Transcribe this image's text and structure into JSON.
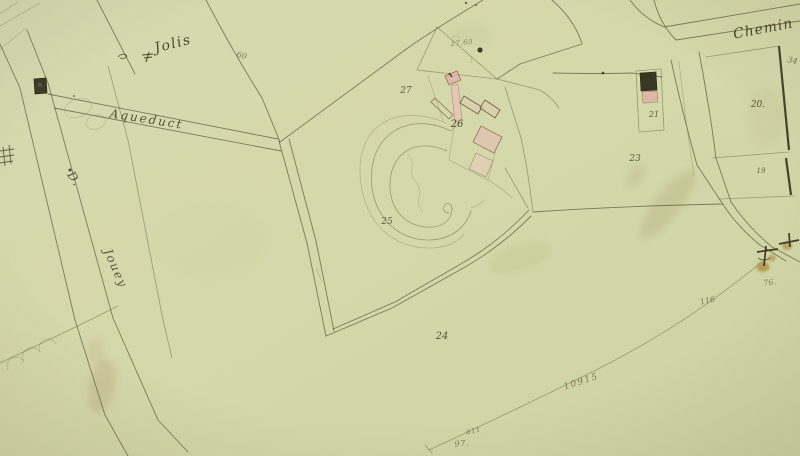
{
  "map": {
    "type": "cadastral-map-scan",
    "colors": {
      "paper": "#d6d9ac",
      "ink": "#5a553b",
      "ink_dark": "#2c2717",
      "building_pink": "#e0b4a8",
      "building_dark": "#2e2a1a",
      "stain_brown": "#a58a5c",
      "tree_ochre": "#a8893c",
      "measure_brown": "#7a5a36"
    },
    "labels": [
      {
        "name": "place-label-jolis",
        "text": "Jolis",
        "x": 174,
        "y": 48,
        "rot": -14,
        "size": 14,
        "ls": 1.5,
        "color": "#3d371f",
        "op": 0.9
      },
      {
        "name": "road-label-aqueduct",
        "text": "Aqueduct",
        "x": 146,
        "y": 123,
        "rot": 9,
        "size": 12,
        "ls": 2,
        "color": "#46402a",
        "op": 0.9
      },
      {
        "name": "road-label-d",
        "text": "D.",
        "x": 71,
        "y": 181,
        "rot": 55,
        "size": 12,
        "ls": 1,
        "color": "#46402a",
        "op": 0.85
      },
      {
        "name": "road-label-jouey",
        "text": "Jouey",
        "x": 112,
        "y": 270,
        "rot": 66,
        "size": 12,
        "ls": 1.5,
        "color": "#46402a",
        "op": 0.85
      },
      {
        "name": "road-label-chemin",
        "text": "Chemin",
        "x": 764,
        "y": 33,
        "rot": -11,
        "size": 14,
        "ls": 1,
        "color": "#3a3419",
        "op": 0.9
      },
      {
        "name": "parcel-number-27",
        "text": "27",
        "x": 406,
        "y": 93,
        "rot": 0,
        "size": 9,
        "ls": 0,
        "color": "#4a4429",
        "op": 0.85
      },
      {
        "name": "parcel-number-26",
        "text": "26",
        "x": 457,
        "y": 127,
        "rot": 0,
        "size": 10,
        "ls": 0,
        "color": "#433d24",
        "op": 0.9
      },
      {
        "name": "parcel-number-25",
        "text": "25",
        "x": 387,
        "y": 224,
        "rot": 0,
        "size": 9,
        "ls": 0,
        "color": "#4a4429",
        "op": 0.85
      },
      {
        "name": "parcel-number-24",
        "text": "24",
        "x": 442,
        "y": 339,
        "rot": 0,
        "size": 10,
        "ls": 0,
        "color": "#433d24",
        "op": 0.85
      },
      {
        "name": "parcel-number-23",
        "text": "23",
        "x": 635,
        "y": 161,
        "rot": 0,
        "size": 9,
        "ls": 0,
        "color": "#4a4429",
        "op": 0.85
      },
      {
        "name": "parcel-number-21",
        "text": "21",
        "x": 654,
        "y": 117,
        "rot": 0,
        "size": 8,
        "ls": 0,
        "color": "#4a4429",
        "op": 0.85
      },
      {
        "name": "parcel-number-20",
        "text": "20.",
        "x": 758,
        "y": 107,
        "rot": 0,
        "size": 9,
        "ls": 0,
        "color": "#433d24",
        "op": 0.85
      },
      {
        "name": "parcel-number-19",
        "text": "19",
        "x": 761,
        "y": 173,
        "rot": 0,
        "size": 7,
        "ls": 0,
        "color": "#4a4429",
        "op": 0.8
      },
      {
        "name": "parcel-number-34",
        "text": "34",
        "x": 792,
        "y": 63,
        "rot": 12,
        "size": 8,
        "ls": 0,
        "color": "#55502f",
        "op": 0.75
      },
      {
        "name": "mark-76",
        "text": "76.",
        "x": 770,
        "y": 285,
        "rot": -8,
        "size": 8,
        "ls": 0,
        "color": "#7a6a32",
        "op": 0.8
      },
      {
        "name": "mark-116",
        "text": "116",
        "x": 708,
        "y": 303,
        "rot": -12,
        "size": 8,
        "ls": 0,
        "color": "#55513a",
        "op": 0.7
      },
      {
        "name": "mark-60",
        "text": "60",
        "x": 241,
        "y": 58,
        "rot": 15,
        "size": 8,
        "ls": 0,
        "color": "#55503a",
        "op": 0.7
      },
      {
        "name": "annotation-27-60",
        "text": "27.60",
        "x": 462,
        "y": 45,
        "rot": -6,
        "size": 7,
        "ls": 0.5,
        "color": "#6b6443",
        "op": 0.7
      },
      {
        "name": "annotation-10915",
        "text": "10915",
        "x": 582,
        "y": 384,
        "rot": -18,
        "size": 9,
        "ls": 1.5,
        "color": "#7a5a36",
        "op": 0.8
      },
      {
        "name": "annotation-611",
        "text": "611",
        "x": 474,
        "y": 433,
        "rot": -14,
        "size": 7,
        "ls": 0.5,
        "color": "#5a5438",
        "op": 0.7
      },
      {
        "name": "annotation-97",
        "text": "97.",
        "x": 462,
        "y": 446,
        "rot": -6,
        "size": 8,
        "ls": 0.5,
        "color": "#5a5438",
        "op": 0.75
      }
    ]
  }
}
